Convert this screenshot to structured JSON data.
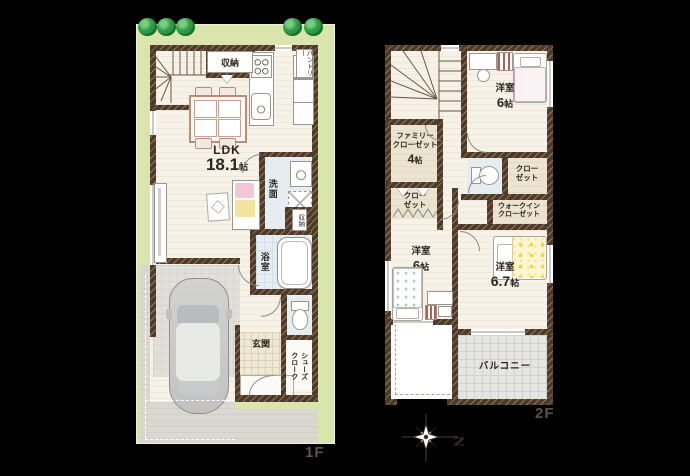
{
  "scene": {
    "floor1_label": "1F",
    "floor2_label": "2F",
    "compass_north": "N"
  },
  "floor1": {
    "ldk_name": "LDK",
    "ldk_num": "18.1",
    "ldk_unit": "帖",
    "closet_top": "収納",
    "pantry": "パントリー",
    "washroom": "洗面",
    "closet_mid": "収納",
    "bathroom": "浴室",
    "entrance": "玄関",
    "shoes_cloak": "シューズ\nクローク"
  },
  "floor2": {
    "family_closet_name": "ファミリー\nクローゼット",
    "family_closet_num": "4",
    "family_closet_unit": "帖",
    "bedroom1_name": "洋室",
    "bedroom1_num": "6",
    "bedroom1_unit": "帖",
    "closet_right": "クロー\nゼット",
    "closet_left": "クロー\nゼット",
    "walk_in_closet": "ウォークイン\nクローゼット",
    "bedroom2_name": "洋室",
    "bedroom2_num": "6",
    "bedroom2_unit": "帖",
    "bedroom3_name": "洋室",
    "bedroom3_num": "6.7",
    "bedroom3_unit": "帖",
    "balcony": "バルコニー"
  },
  "colors": {
    "lot_green": "#d9e5ac",
    "wall_brown": "#4e3a28",
    "floor_cream": "#f6f2e7",
    "wet_blue": "#e5edf0",
    "beige": "#ece4d1",
    "tile_beige": "#efe8d7",
    "pave_gray": "#dbd8d2",
    "balcony_gray": "#e5e5e3",
    "tree_green": "#2f9e48",
    "text_dark": "#2c2620",
    "label_gray": "#5a544c",
    "accent_pink": "#f3c6d5",
    "accent_yellow": "#f2e49c"
  }
}
